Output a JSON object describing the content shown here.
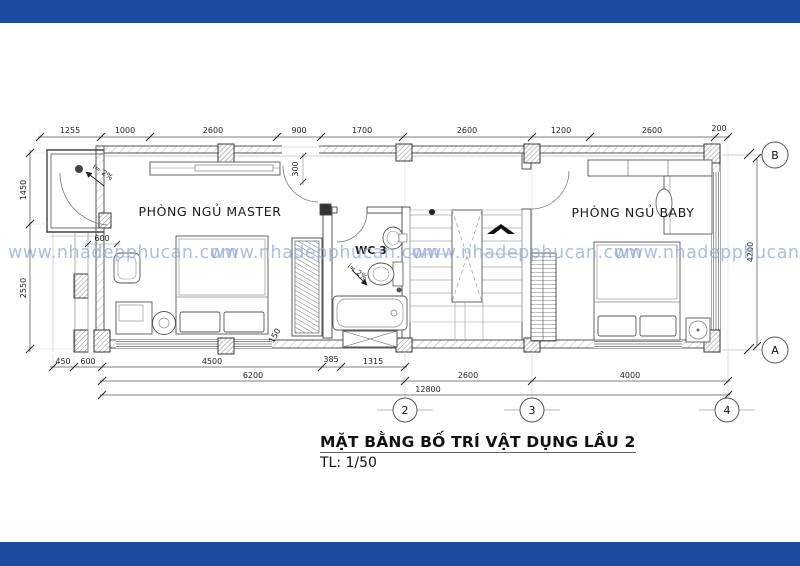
{
  "page": {
    "band_color": "#1b4a9e",
    "paper_color": "#ffffff"
  },
  "watermark": {
    "text": "www.nhadepphucan.com",
    "color": "#96aed8"
  },
  "title_block": {
    "title": "MẶT BẰNG BỐ TRÍ VẬT DỤNG LẦU 2",
    "scale_label": "TL: 1/50"
  },
  "rooms": {
    "master_label": "PHÒNG NGỦ MASTER",
    "wc_label": "WC 3",
    "baby_label": "PHÒNG NGỦ BABY"
  },
  "annotations": {
    "balcony_slope": "i= 2%",
    "wc_slope": "i= 2%",
    "balcony_width_dim": "600",
    "door_offset_dim": "300",
    "closet_dim": "150"
  },
  "dimensions": {
    "top": [
      "1255",
      "1000",
      "2600",
      "900",
      "1700",
      "2600",
      "1200",
      "2600",
      "200"
    ],
    "bottom_detail": [
      "450",
      "600",
      "4500",
      "385",
      "1315"
    ],
    "bottom_mid": [
      "6200",
      "2600",
      "4000"
    ],
    "bottom_total": "12800",
    "left": [
      "1450",
      "2550"
    ],
    "right": "4200"
  },
  "grid_bubbles": {
    "col_2": "2",
    "col_3": "3",
    "col_4": "4",
    "row_a": "A",
    "row_b": "B"
  }
}
